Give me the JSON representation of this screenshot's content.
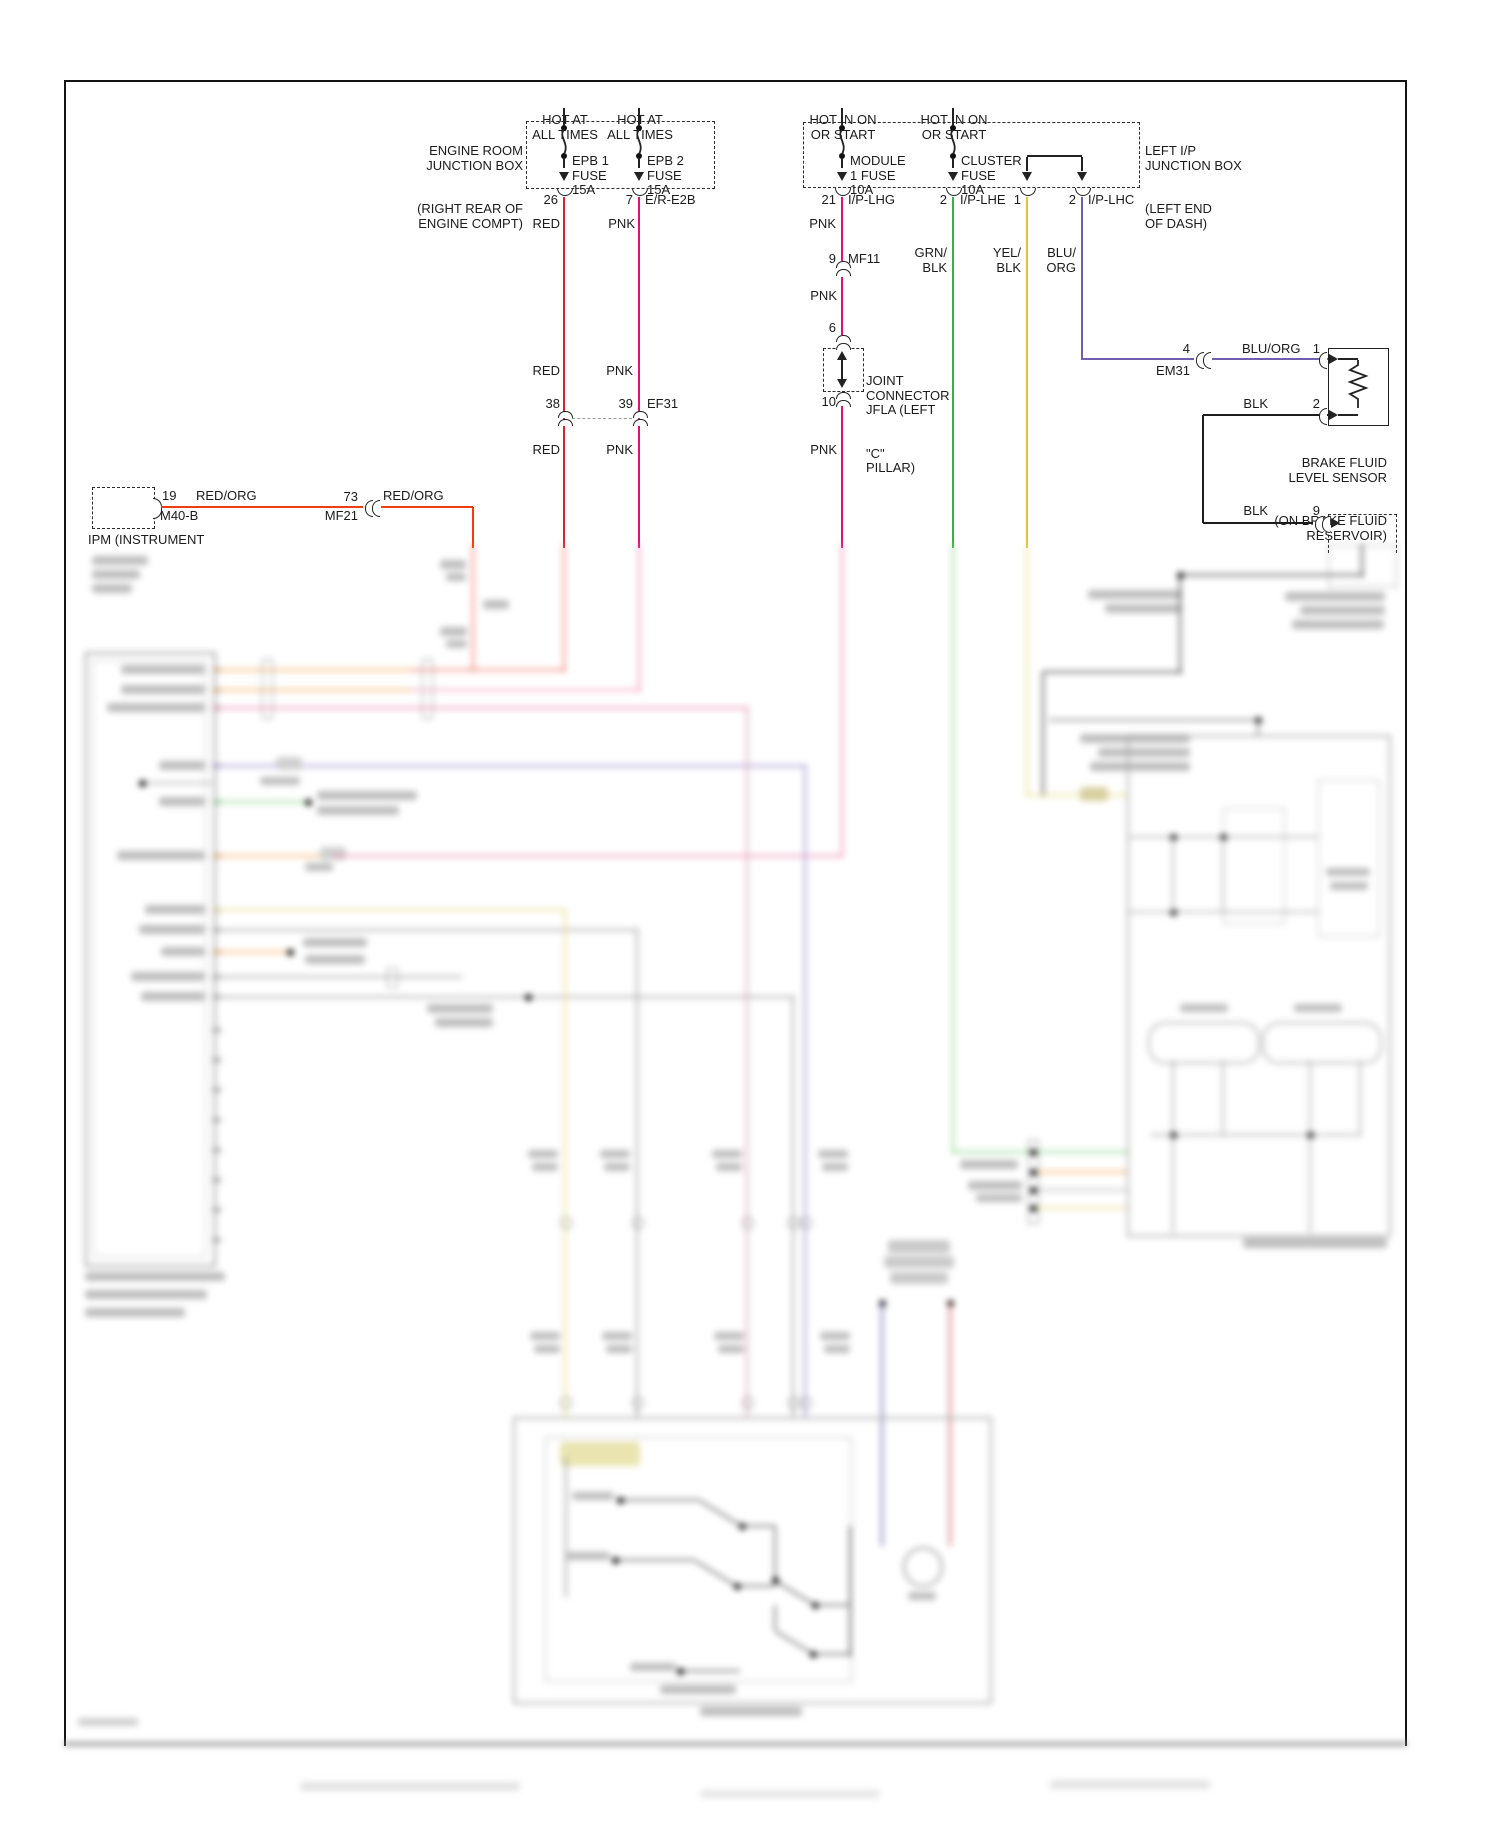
{
  "colors": {
    "red": "#df2127",
    "pnk": "#e50d77",
    "red_org": "#ee3c13",
    "grn": "#3fae48",
    "yel": "#ddc732",
    "blu_org": "#6f5fae",
    "blk": "#1d1d1d"
  },
  "erjb": {
    "label": [
      "ENGINE ROOM",
      "JUNCTION BOX",
      "(RIGHT REAR OF",
      "ENGINE COMPT)"
    ],
    "fuse1": {
      "hot1": "HOT AT",
      "hot2": "ALL TIMES",
      "l1": "EPB 1",
      "l2": "FUSE",
      "l3": "15A",
      "pin": "26",
      "wire": "RED"
    },
    "fuse2": {
      "hot1": "HOT AT",
      "hot2": "ALL TIMES",
      "l1": "EPB 2",
      "l2": "FUSE",
      "l3": "15A",
      "pin": "7",
      "conn": "E/R-E2B",
      "wire": "PNK"
    }
  },
  "lipjb": {
    "label": [
      "LEFT I/P",
      "JUNCTION BOX",
      "(LEFT END",
      "OF DASH)"
    ],
    "fuse1": {
      "hot1": "HOT IN ON",
      "hot2": "OR START",
      "l1": "MODULE",
      "l2": "1 FUSE",
      "l3": "10A",
      "pin": "21",
      "conn": "I/P-LHG",
      "wire": "PNK"
    },
    "fuse2": {
      "hot1": "HOT IN ON",
      "hot2": "OR START",
      "l1": "CLUSTER",
      "l2": "FUSE",
      "l3": "10A",
      "pin": "2",
      "conn": "I/P-LHE",
      "wire1": "GRN/",
      "wire2": "BLK"
    },
    "pin3": {
      "pin": "1",
      "wire1": "YEL/",
      "wire2": "BLK"
    },
    "pin4": {
      "pin": "2",
      "conn": "I/P-LHC",
      "wire1": "BLU/",
      "wire2": "ORG"
    }
  },
  "pnk_path": {
    "pin9": "9",
    "mf11": "MF11",
    "pnk1": "PNK",
    "pin6": "6",
    "jc": [
      "JOINT",
      "CONNECTOR",
      "JFLA (LEFT",
      "\"C\"",
      "PILLAR)"
    ],
    "pin10": "10",
    "pnk2": "PNK"
  },
  "epb_path": {
    "red1": "RED",
    "pnk1": "PNK",
    "pin38": "38",
    "pin39": "39",
    "conn": "EF31",
    "red2": "RED",
    "pnk2": "PNK"
  },
  "ipm": {
    "pin19": "19",
    "conn1": "M40-B",
    "wire1": "RED/ORG",
    "pin73": "73",
    "conn2": "MF21",
    "wire2": "RED/ORG",
    "label": "IPM (INSTRUMENT"
  },
  "sensor": {
    "pin4": "4",
    "conn": "EM31",
    "wire": "BLU/ORG",
    "pin1": "1",
    "label": [
      "BRAKE FLUID",
      "LEVEL SENSOR",
      "(ON BRAKE FLUID",
      "RESERVOIR)"
    ],
    "blk1": "BLK",
    "pin2": "2",
    "blk2": "BLK",
    "pin9": "9"
  }
}
